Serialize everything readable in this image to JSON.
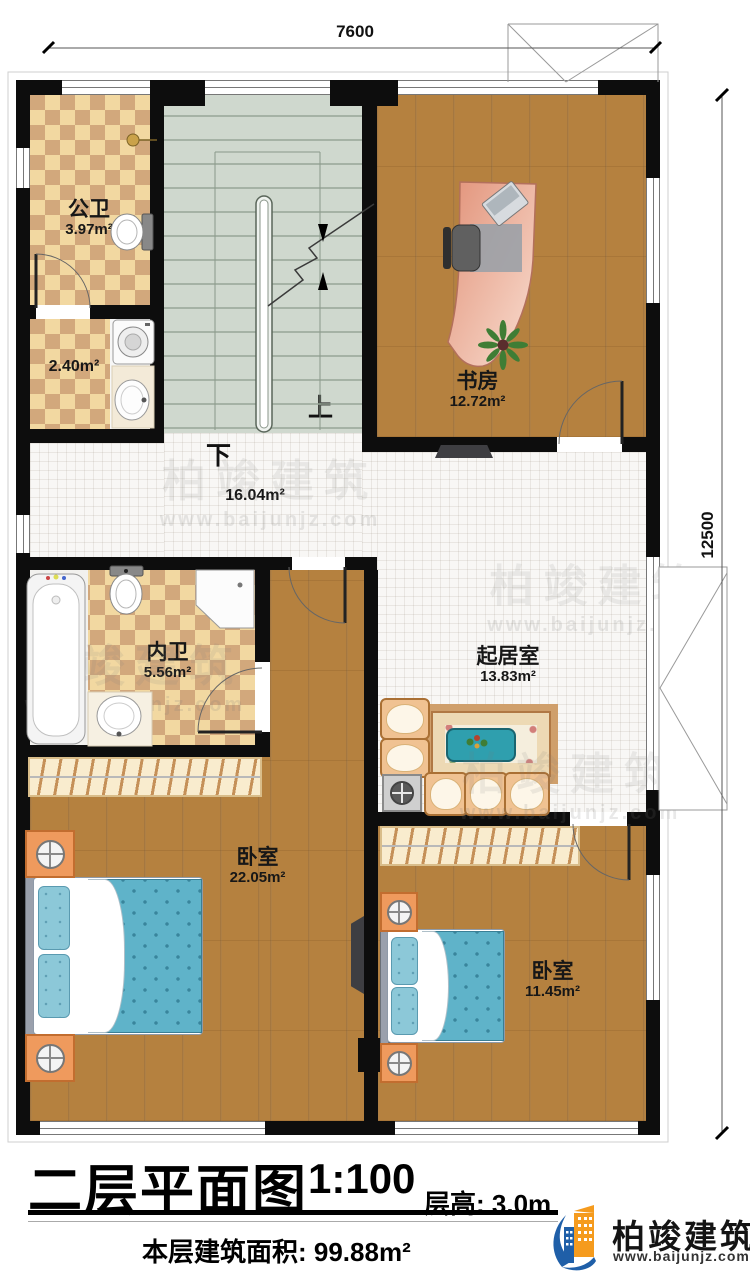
{
  "dimensions": {
    "width_top": "7600",
    "height_right": "12500"
  },
  "rooms": {
    "public_bath": {
      "name": "公卫",
      "area": "3.97m²"
    },
    "laundry": {
      "area": "2.40m²"
    },
    "study": {
      "name": "书房",
      "area": "12.72m²"
    },
    "hallway": {
      "area": "16.04m²"
    },
    "ensuite_bath": {
      "name": "内卫",
      "area": "5.56m²"
    },
    "living_room": {
      "name": "起居室",
      "area": "13.83m²"
    },
    "bedroom_master": {
      "name": "卧室",
      "area": "22.05m²"
    },
    "bedroom_second": {
      "name": "卧室",
      "area": "11.45m²"
    }
  },
  "stairs": {
    "up_label": "上",
    "down_label": "下"
  },
  "title_block": {
    "title": "二层平面图",
    "scale": "1:100",
    "floor_height_label": "层高: 3.0m",
    "floor_area_label": "本层建筑面积: 99.88m²"
  },
  "branding": {
    "company": "柏竣建筑",
    "website": "www.baijunjz.com"
  },
  "watermark": {
    "text": "柏竣建筑",
    "url": "www.baijunjz.com"
  },
  "colors": {
    "wall": "#0d0d0d",
    "tile_light": "#f2d8a1",
    "tile_dark": "#d2a87c",
    "stair": "#cfd8ce",
    "wood": "#b5813f",
    "bed_blanket": "#5fb3c9",
    "sofa": "#f0c292",
    "desk": "#e2967c",
    "coffee_table": "#2f9fae",
    "logo_blue": "#1f5fa8",
    "logo_orange": "#f59b1e"
  }
}
